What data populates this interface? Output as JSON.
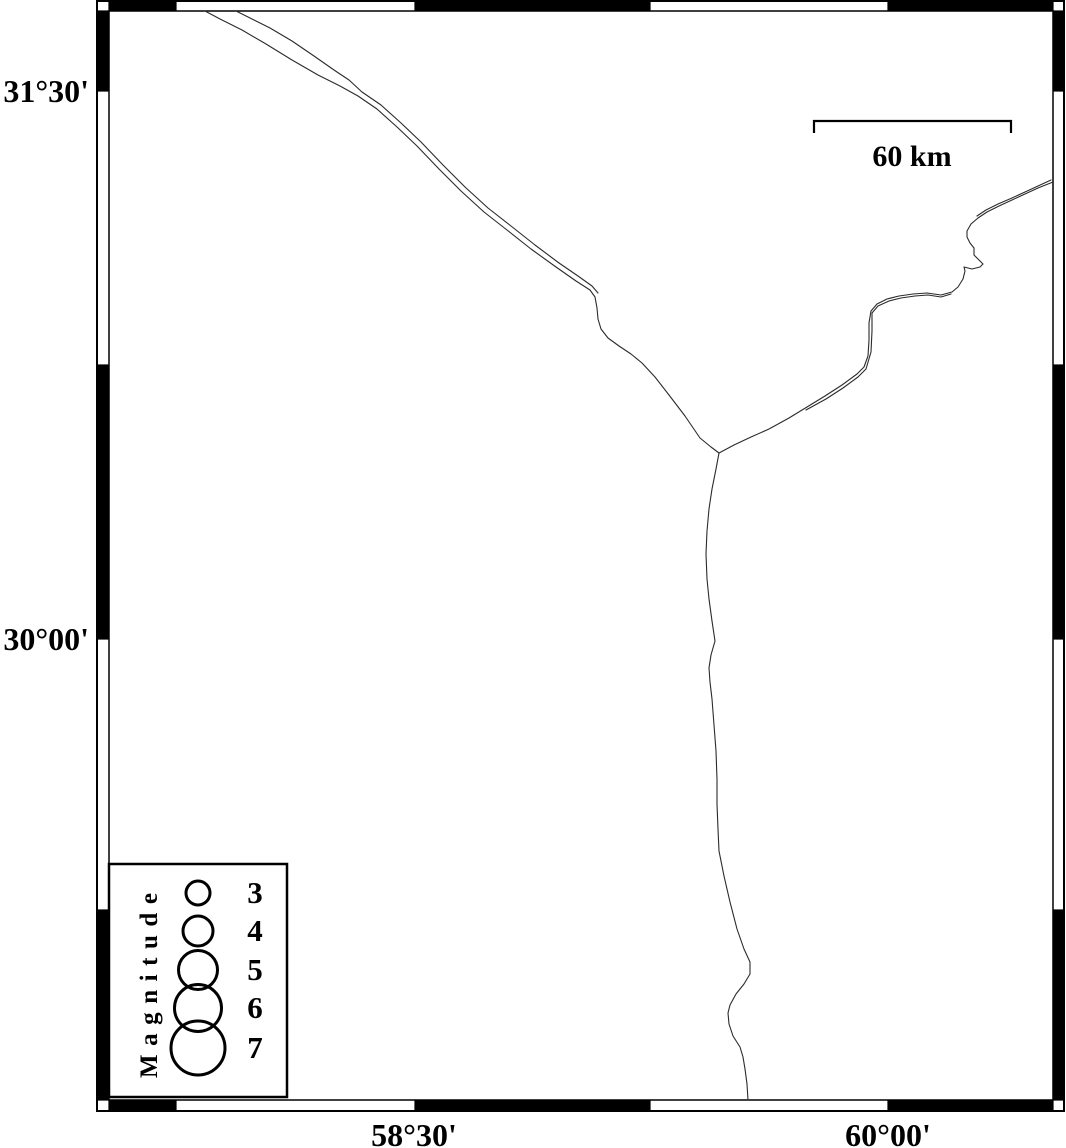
{
  "figure": {
    "kind": "seismicity-map",
    "background": "#ffffff",
    "ink": "#000000"
  },
  "map": {
    "frame": {
      "outer": {
        "x": 97,
        "y": 1,
        "w": 967,
        "h": 1110
      },
      "inner": {
        "x": 109,
        "y": 11,
        "w": 944,
        "h": 1089
      },
      "x_ticks": [
        176,
        415,
        650,
        888
      ],
      "y_ticks": [
        91,
        365,
        639,
        910
      ]
    },
    "axis_labels": {
      "left": [
        {
          "text": "31°30'"
        },
        {
          "text": "30°00'"
        }
      ],
      "bottom": [
        {
          "text": "58°30'"
        },
        {
          "text": "60°00'"
        }
      ]
    },
    "scalebar": {
      "label": "60 km",
      "x1": 814,
      "x2": 1011,
      "y": 121,
      "tick_len": 12,
      "label_x": 912,
      "label_y": 166
    },
    "legend": {
      "title": "Magnitude",
      "box": {
        "x": 109,
        "y": 864,
        "w": 178,
        "h": 233
      },
      "circle_cx": 198,
      "label_x": 255,
      "stroke_width": 3,
      "items": [
        {
          "label": "3",
          "cy": 893,
          "r": 12
        },
        {
          "label": "4",
          "cy": 931,
          "r": 15
        },
        {
          "label": "5",
          "cy": 970,
          "r": 19.5
        },
        {
          "label": "6",
          "cy": 1008,
          "r": 23.5
        },
        {
          "label": "7",
          "cy": 1048,
          "r": 27
        }
      ]
    },
    "lines": [
      {
        "name": "boundary-nw-main",
        "points": "205,11 220,19 242,30 266,44 292,60 318,75 340,86 358,96 377,109 397,127 417,146 439,169 461,191 484,212 507,230 531,249 556,267 576,281 590,290 595,297 597,308 598,319 601,329 608,338 619,346 631,354 642,363 655,377 669,395 685,416 700,438 711,447 719,453"
      },
      {
        "name": "boundary-nw-second",
        "points": "236,11 252,19 270,28 292,41 314,56 334,70 349,80 362,92 381,105 401,123 421,142 443,165 465,187 488,208 511,226 535,245 559,263 578,276 592,286 598,293"
      },
      {
        "name": "boundary-ne-main",
        "points": "719,453 734,445 751,437 769,429 789,418 807,407 825,396 842,385 857,374 864,367 868,356 869,340 869,323 871,311 877,304 887,299 899,296 913,294 927,293 941,295 952,292 958,287 963,279 965,271 964,267 972,269 980,267 983,264 979,260 974,255 974,248 970,243 967,237 967,231 971,224 978,218 987,212 999,206 1012,200 1025,194 1038,188 1053,182"
      },
      {
        "name": "boundary-ne-second-lower",
        "points": "806,410 826,399 843,388 858,377 866,369 871,352 872,331 872,313 878,306 889,301 901,298 915,296 928,295 941,297 951,294"
      },
      {
        "name": "boundary-ne-second-upper",
        "points": "977,216 986,210 998,204 1012,198 1025,192 1038,186 1051,180"
      },
      {
        "name": "boundary-south",
        "points": "719,453 716,469 712,489 709,509 707,531 706,554 707,579 709,599 712,621 715,641 711,655 709,668 710,682 712,699 714,725 716,751 717,779 717,804 718,829 719,851 724,876 730,902 737,929 744,949 750,962 750,974 744,984 736,994 730,1005 728,1013 729,1024 733,1036 740,1047 743,1057 745,1069 747,1084 748,1100"
      }
    ]
  }
}
